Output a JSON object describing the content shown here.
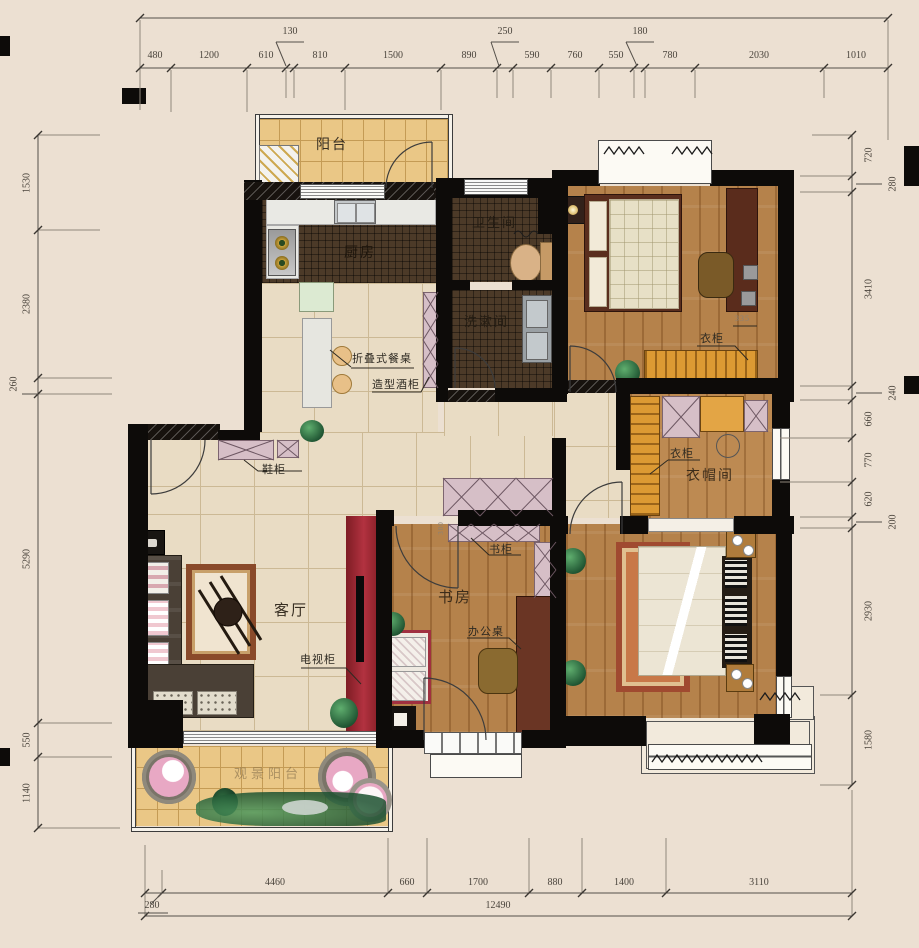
{
  "plan": {
    "rooms": {
      "balcony_top": "阳台",
      "kitchen": "厨房",
      "bathroom": "卫生间",
      "washroom": "洗漱间",
      "living_room": "客厅",
      "study": "书房",
      "cloakroom": "衣帽间",
      "scenic_balcony": "观景阳台"
    },
    "furniture": {
      "shoe_cabinet": "鞋柜",
      "folding_dining_table": "折叠式餐桌",
      "wine_cabinet": "造型酒柜",
      "tv_cabinet": "电视柜",
      "bookcase": "书柜",
      "office_desk": "办公桌",
      "wardrobe_bedroom": "衣柜",
      "wardrobe_cloakroom": "衣柜",
      "note_335": "335",
      "note_300": "300"
    }
  },
  "dims": {
    "top": [
      "480",
      "1200",
      "610",
      "130",
      "810",
      "1500",
      "890",
      "250",
      "590",
      "760",
      "550",
      "180",
      "780",
      "2030",
      "1010"
    ],
    "left": [
      "1530",
      "2380",
      "260",
      "5290",
      "550",
      "1140"
    ],
    "right": [
      "720",
      "280",
      "3410",
      "240",
      "660",
      "770",
      "620",
      "200",
      "2930",
      "1580"
    ],
    "bottom": [
      "280",
      "4460",
      "660",
      "1700",
      "880",
      "1400",
      "3110"
    ],
    "total": "12490"
  }
}
